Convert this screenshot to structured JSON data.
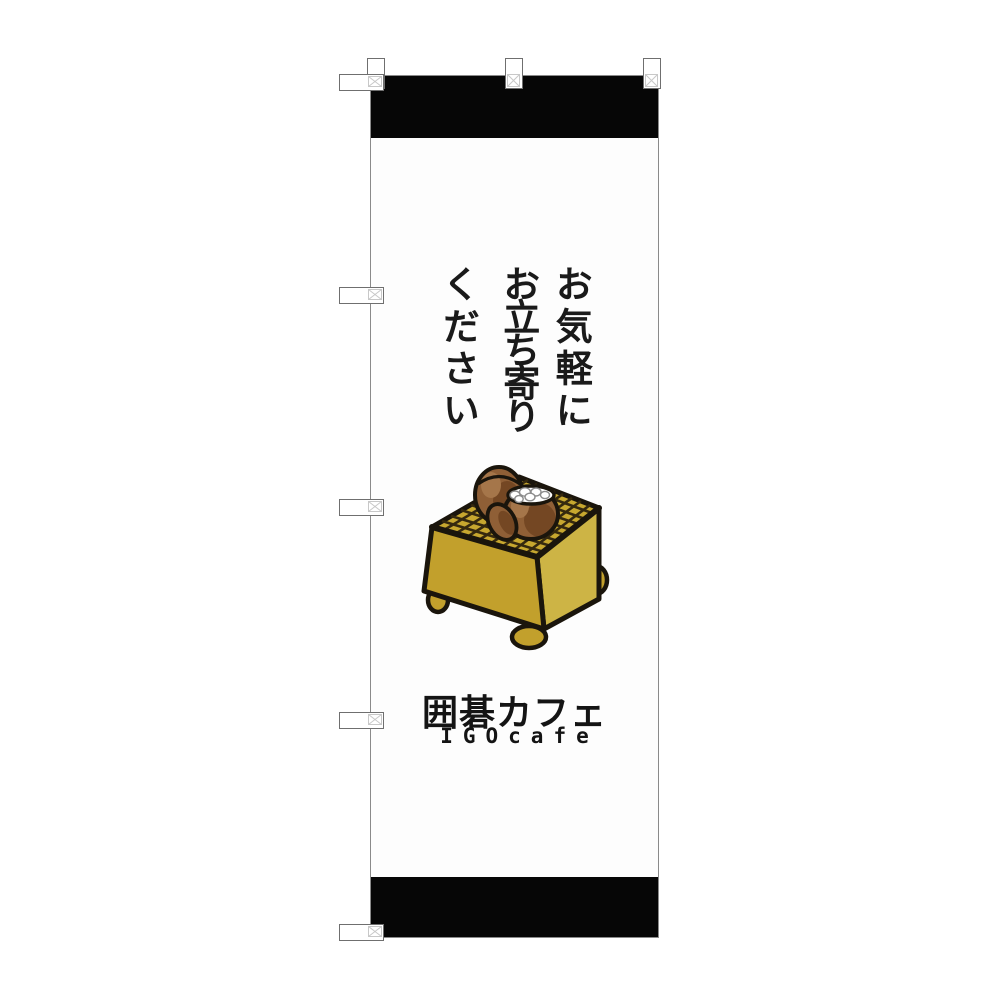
{
  "banner": {
    "main_copy": {
      "lines": [
        "お気軽に",
        "お立ち寄り",
        "ください"
      ],
      "full_text": "お気軽にお立ち寄りください"
    },
    "logo": {
      "jp": "囲碁カフェ",
      "en": "IGOcafe"
    },
    "illustration": "goban-with-go-stone-bowls",
    "colors": {
      "band_black": "#060606",
      "banner_white": "#fdfdfd",
      "board_gold": "#c7a72f",
      "board_gold_front": "#c2a02c",
      "board_gold_light": "#cdb445",
      "bowl_brown": "#8f5f36",
      "bowl_brown_dark": "#744723",
      "bowl_brown_light": "#a5764a",
      "outline_ink": "#1a150c",
      "text_ink": "#1a1a1a",
      "tab_border_gray": "#6f6f6f",
      "stitch_gray": "#c8c8c8"
    },
    "hardware": {
      "top_tab_count": 3,
      "side_tab_count": 5
    }
  }
}
